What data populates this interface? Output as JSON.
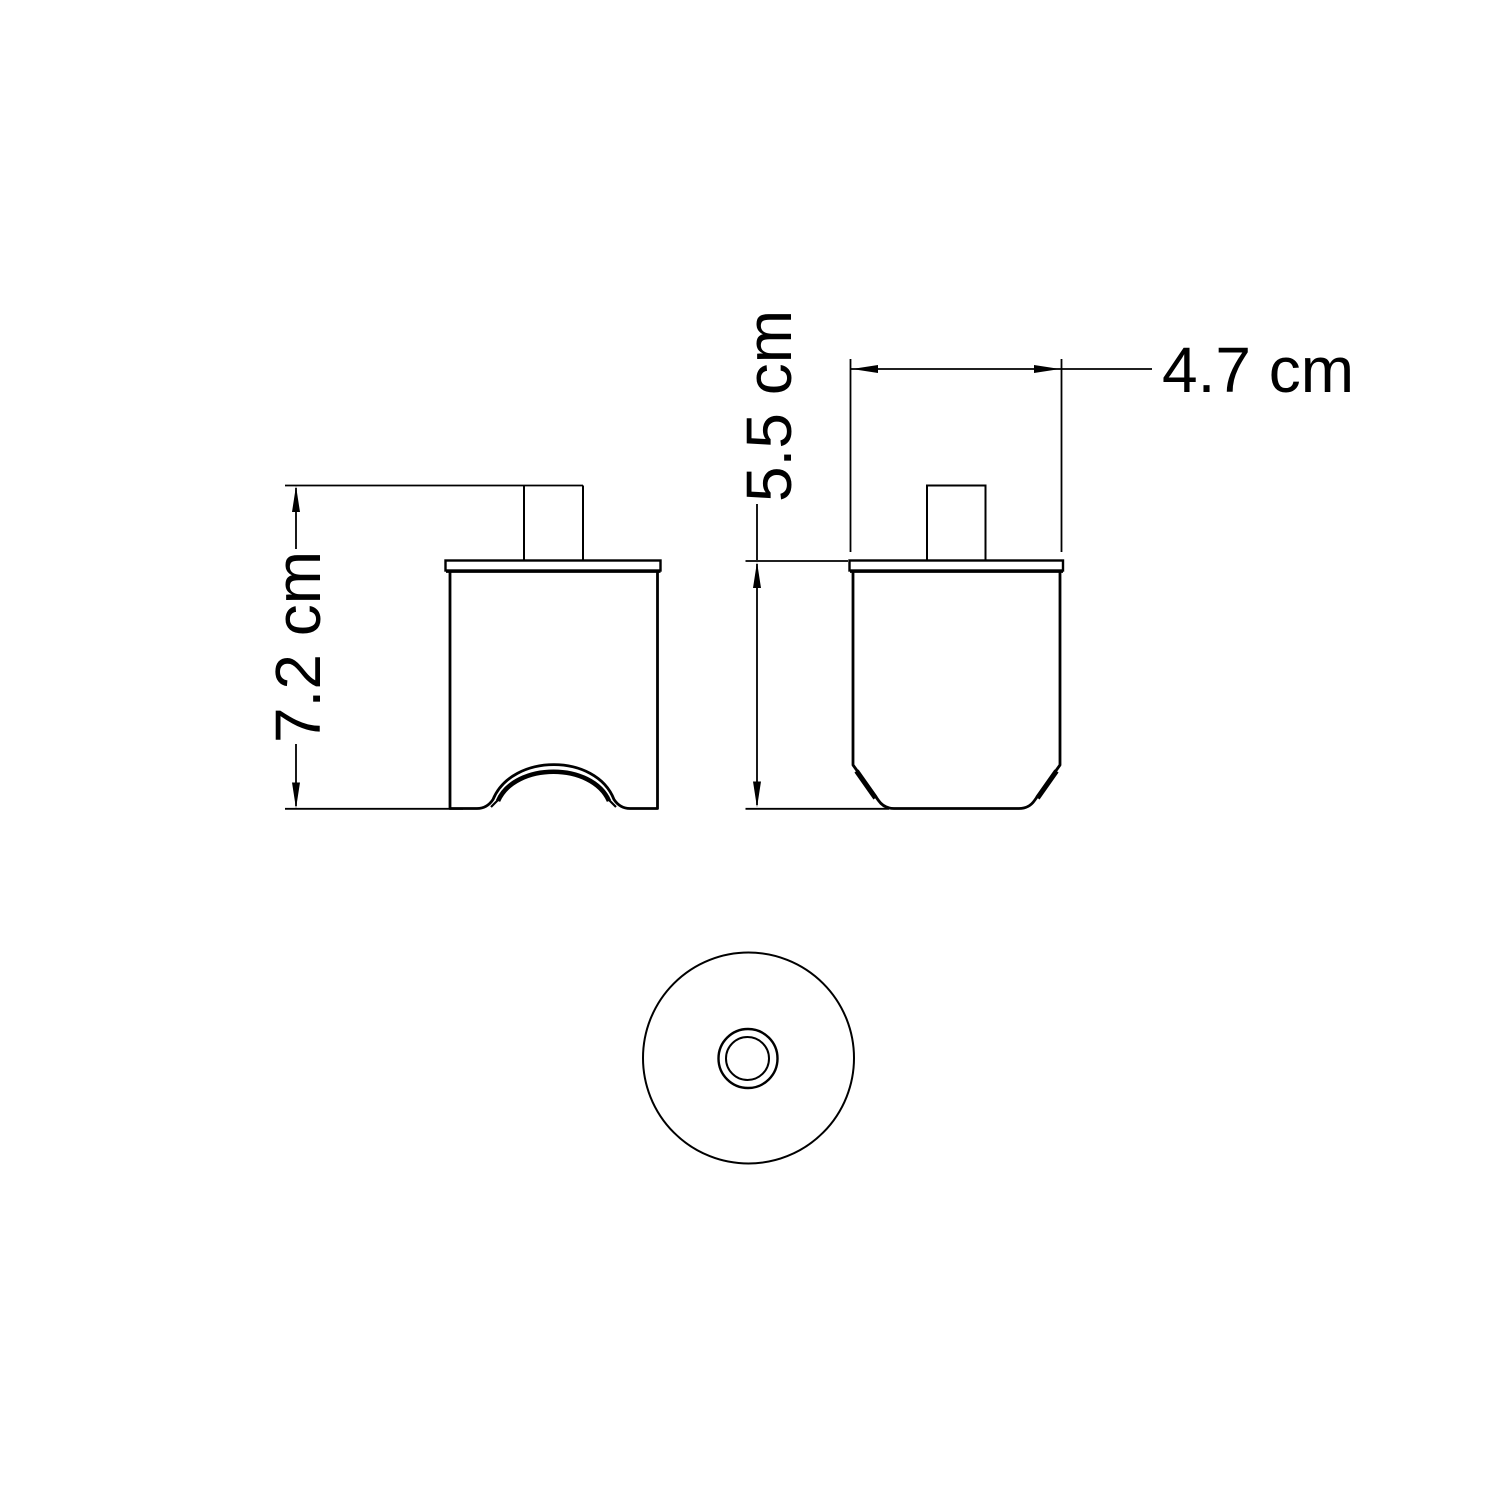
{
  "colors": {
    "background": "#ffffff",
    "line": "#000000"
  },
  "drawing_labels": {
    "dim_height_left": "7.2 cm",
    "dim_height_right": "5.5 cm",
    "dim_width_top": "4.7 cm"
  }
}
